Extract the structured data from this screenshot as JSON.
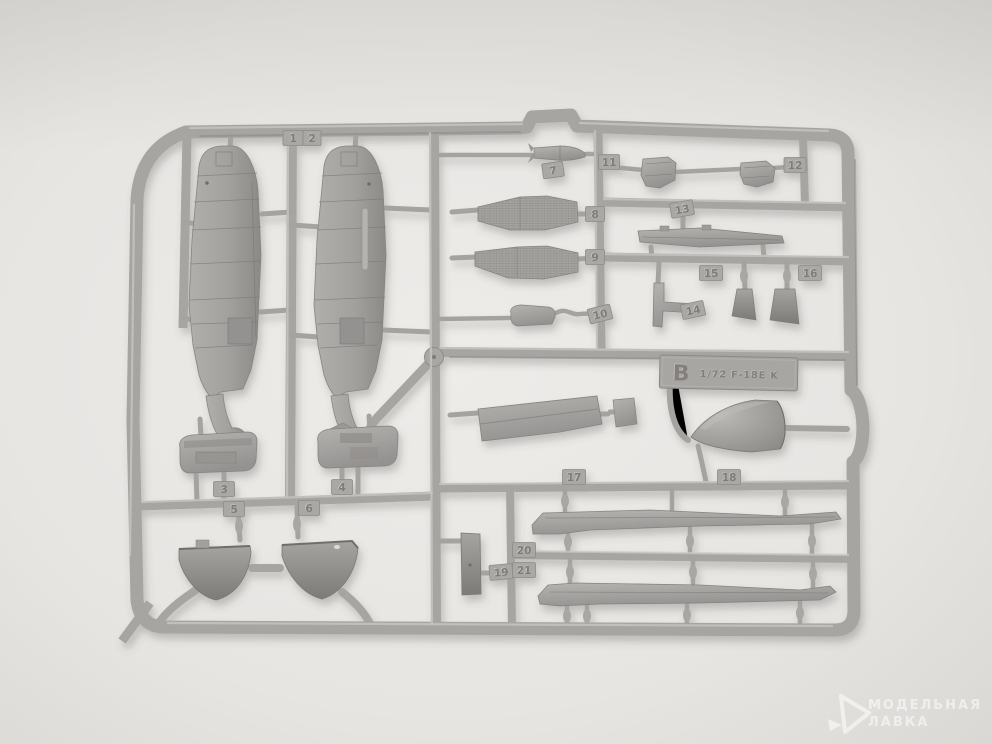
{
  "sprue": {
    "label": {
      "series_letter": "B",
      "title": "1/72 F-18E K"
    },
    "part_numbers": [
      "1",
      "2",
      "3",
      "4",
      "5",
      "6",
      "7",
      "8",
      "9",
      "10",
      "11",
      "12",
      "13",
      "14",
      "15",
      "16",
      "17",
      "18",
      "19",
      "20",
      "21"
    ]
  },
  "watermark": {
    "line1": "МОДЕЛЬНАЯ",
    "line2": "ЛАВКА"
  },
  "colors": {
    "background": "#e9e7e4",
    "plastic": "#a7a5a2",
    "plastic_highlight": "#c9c7c4",
    "plastic_shadow": "#8a8885",
    "part_dark": "#8f8d8a",
    "watermark": "#ffffff"
  }
}
